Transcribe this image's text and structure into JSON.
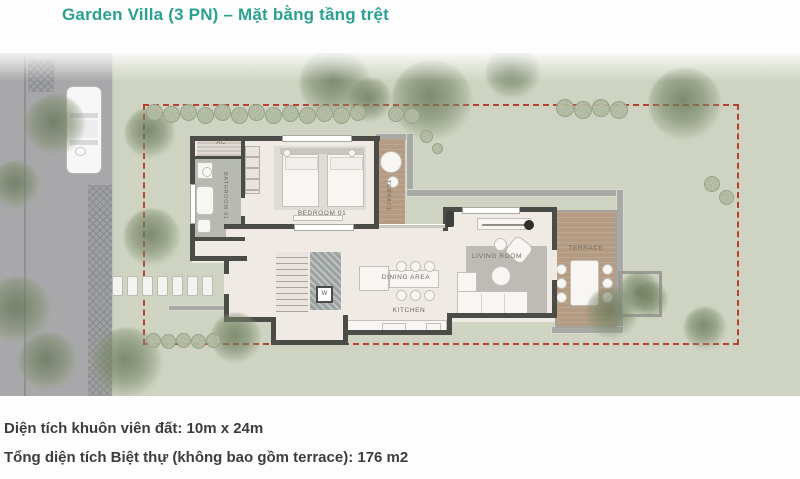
{
  "title": "Garden Villa (3 PN) – Mặt bằng tầng trệt",
  "plan": {
    "rooms": {
      "ac": "AC",
      "bathroom": "BATHROOM 01",
      "bedroom": "BEDROOM 01",
      "terrace_upper": "TERRACE",
      "dining": "DINING AREA",
      "kitchen": "KITCHEN",
      "living": "LIVING ROOM",
      "terrace_right": "TERRACE",
      "washer": "W"
    },
    "site": {
      "boundary_style": "red-dashed",
      "lot_size": "10m x 24m"
    },
    "colors": {
      "title_teal": "#2aa190",
      "lawn": "#ced4c1",
      "road_gray": "#a8a8aa",
      "wall_dark": "#4b4b48",
      "floor_cream": "#efeae3",
      "bathroom_gray": "#b6bab0",
      "wood_deck": "#b59b82",
      "boundary_red": "#b5432f"
    }
  },
  "footer": {
    "line1": "Diện tích khuôn viên đất: 10m x 24m",
    "line2": "Tổng diện tích Biệt thự (không bao gồm terrace): 176 m2"
  }
}
